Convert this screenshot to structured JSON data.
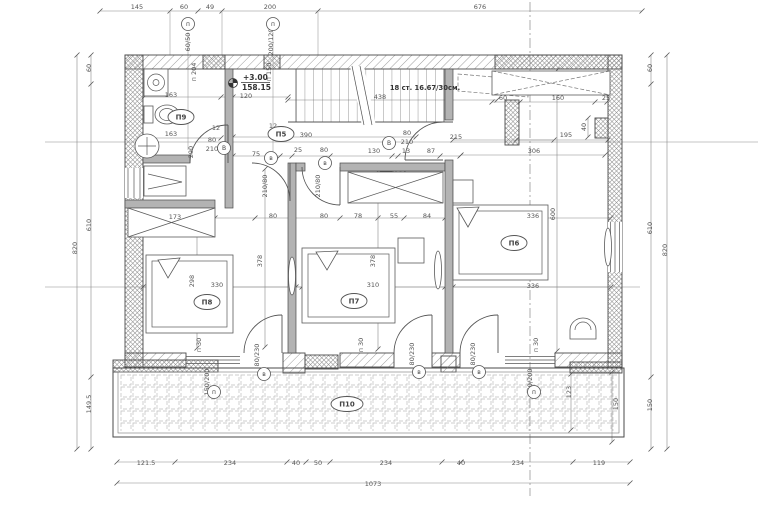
{
  "drawing": {
    "type": "architectural-floor-plan",
    "stairs": {
      "note": "18 ст. 16.67/30см."
    },
    "elevation": {
      "relative": "+3.00",
      "absolute": "158.15"
    },
    "rooms": [
      {
        "id": "П5",
        "x": 281,
        "y": 134
      },
      {
        "id": "П6",
        "x": 514,
        "y": 243
      },
      {
        "id": "П7",
        "x": 354,
        "y": 301
      },
      {
        "id": "П8",
        "x": 207,
        "y": 302
      },
      {
        "id": "П9",
        "x": 181,
        "y": 117
      },
      {
        "id": "П10",
        "x": 347,
        "y": 404
      }
    ],
    "tags": [
      {
        "t": "п",
        "x": 188,
        "y": 24
      },
      {
        "t": "п",
        "x": 273,
        "y": 24
      },
      {
        "t": "В",
        "x": 224,
        "y": 148
      },
      {
        "t": "в",
        "x": 271,
        "y": 158
      },
      {
        "t": "в",
        "x": 325,
        "y": 163
      },
      {
        "t": "В",
        "x": 389,
        "y": 143
      },
      {
        "t": "в",
        "x": 264,
        "y": 374
      },
      {
        "t": "в",
        "x": 419,
        "y": 372
      },
      {
        "t": "в",
        "x": 479,
        "y": 372
      },
      {
        "t": "п",
        "x": 214,
        "y": 392
      },
      {
        "t": "п",
        "x": 534,
        "y": 392
      }
    ],
    "labels": [
      {
        "t": "145",
        "x": 137,
        "y": 9
      },
      {
        "t": "60",
        "x": 184,
        "y": 9
      },
      {
        "t": "49",
        "x": 210,
        "y": 9
      },
      {
        "t": "200",
        "x": 270,
        "y": 9
      },
      {
        "t": "676",
        "x": 480,
        "y": 9
      },
      {
        "t": "60",
        "x": 91,
        "y": 68,
        "r": -90
      },
      {
        "t": "610",
        "x": 91,
        "y": 225,
        "r": -90
      },
      {
        "t": "149.5",
        "x": 91,
        "y": 404,
        "r": -90
      },
      {
        "t": "820",
        "x": 77,
        "y": 248,
        "r": -90
      },
      {
        "t": "60",
        "x": 652,
        "y": 68,
        "r": -90
      },
      {
        "t": "610",
        "x": 652,
        "y": 228,
        "r": -90
      },
      {
        "t": "150",
        "x": 652,
        "y": 405,
        "r": -90
      },
      {
        "t": "820",
        "x": 667,
        "y": 250,
        "r": -90
      },
      {
        "t": "121.5",
        "x": 146,
        "y": 465
      },
      {
        "t": "234",
        "x": 230,
        "y": 465
      },
      {
        "t": "40",
        "x": 296,
        "y": 465
      },
      {
        "t": "50",
        "x": 318,
        "y": 465
      },
      {
        "t": "234",
        "x": 386,
        "y": 465
      },
      {
        "t": "40",
        "x": 461,
        "y": 465
      },
      {
        "t": "234",
        "x": 518,
        "y": 465
      },
      {
        "t": "119",
        "x": 599,
        "y": 465
      },
      {
        "t": "1073",
        "x": 373,
        "y": 486
      },
      {
        "t": "60/50",
        "x": 190,
        "y": 42,
        "r": -90
      },
      {
        "t": "200/120",
        "x": 273,
        "y": 42,
        "r": -90
      },
      {
        "t": "п 204",
        "x": 196,
        "y": 72,
        "r": -90
      },
      {
        "t": "п 150",
        "x": 271,
        "y": 72,
        "r": -90
      },
      {
        "t": "163",
        "x": 171,
        "y": 97
      },
      {
        "t": "120",
        "x": 246,
        "y": 98
      },
      {
        "t": "438",
        "x": 380,
        "y": 99
      },
      {
        "t": "163",
        "x": 171,
        "y": 136
      },
      {
        "t": "12",
        "x": 216,
        "y": 130
      },
      {
        "t": "12",
        "x": 273,
        "y": 128
      },
      {
        "t": "290",
        "x": 193,
        "y": 152,
        "r": -90
      },
      {
        "t": "80",
        "x": 212,
        "y": 142
      },
      {
        "t": "210",
        "x": 212,
        "y": 151
      },
      {
        "t": "390",
        "x": 306,
        "y": 137
      },
      {
        "t": "215",
        "x": 456,
        "y": 139
      },
      {
        "t": "195",
        "x": 566,
        "y": 137
      },
      {
        "t": "75",
        "x": 256,
        "y": 156
      },
      {
        "t": "25",
        "x": 298,
        "y": 152
      },
      {
        "t": "80",
        "x": 324,
        "y": 152
      },
      {
        "t": "130",
        "x": 374,
        "y": 153
      },
      {
        "t": "13",
        "x": 406,
        "y": 153
      },
      {
        "t": "87",
        "x": 431,
        "y": 153
      },
      {
        "t": "306",
        "x": 534,
        "y": 153
      },
      {
        "t": "80",
        "x": 407,
        "y": 135
      },
      {
        "t": "210",
        "x": 407,
        "y": 144
      },
      {
        "t": "210/80",
        "x": 267,
        "y": 186,
        "r": -90
      },
      {
        "t": "210/80",
        "x": 320,
        "y": 186,
        "r": -90
      },
      {
        "t": "60",
        "x": 503,
        "y": 100
      },
      {
        "t": "160",
        "x": 558,
        "y": 100
      },
      {
        "t": "25",
        "x": 606,
        "y": 100
      },
      {
        "t": "40",
        "x": 586,
        "y": 127,
        "r": -90
      },
      {
        "t": "173",
        "x": 175,
        "y": 219
      },
      {
        "t": "80",
        "x": 273,
        "y": 218
      },
      {
        "t": "80",
        "x": 324,
        "y": 218
      },
      {
        "t": "78",
        "x": 358,
        "y": 218
      },
      {
        "t": "55",
        "x": 394,
        "y": 218
      },
      {
        "t": "84",
        "x": 427,
        "y": 218
      },
      {
        "t": "336",
        "x": 533,
        "y": 218
      },
      {
        "t": "600",
        "x": 555,
        "y": 214,
        "r": -90
      },
      {
        "t": "298",
        "x": 194,
        "y": 281,
        "r": -90
      },
      {
        "t": "330",
        "x": 217,
        "y": 287
      },
      {
        "t": "378",
        "x": 262,
        "y": 261,
        "r": -90
      },
      {
        "t": "310",
        "x": 373,
        "y": 287
      },
      {
        "t": "378",
        "x": 375,
        "y": 261,
        "r": -90
      },
      {
        "t": "336",
        "x": 533,
        "y": 288
      },
      {
        "t": "п 30",
        "x": 201,
        "y": 345,
        "r": -90
      },
      {
        "t": "п 30",
        "x": 363,
        "y": 345,
        "r": -90
      },
      {
        "t": "п 30",
        "x": 538,
        "y": 345,
        "r": -90
      },
      {
        "t": "80/230",
        "x": 259,
        "y": 355,
        "r": -90
      },
      {
        "t": "80/230",
        "x": 414,
        "y": 354,
        "r": -90
      },
      {
        "t": "80/230",
        "x": 475,
        "y": 354,
        "r": -90
      },
      {
        "t": "150/200",
        "x": 209,
        "y": 382,
        "r": -90
      },
      {
        "t": "150/200",
        "x": 532,
        "y": 382,
        "r": -90
      },
      {
        "t": "123",
        "x": 571,
        "y": 392,
        "r": -90
      },
      {
        "t": "150",
        "x": 618,
        "y": 404,
        "r": -90
      }
    ]
  }
}
